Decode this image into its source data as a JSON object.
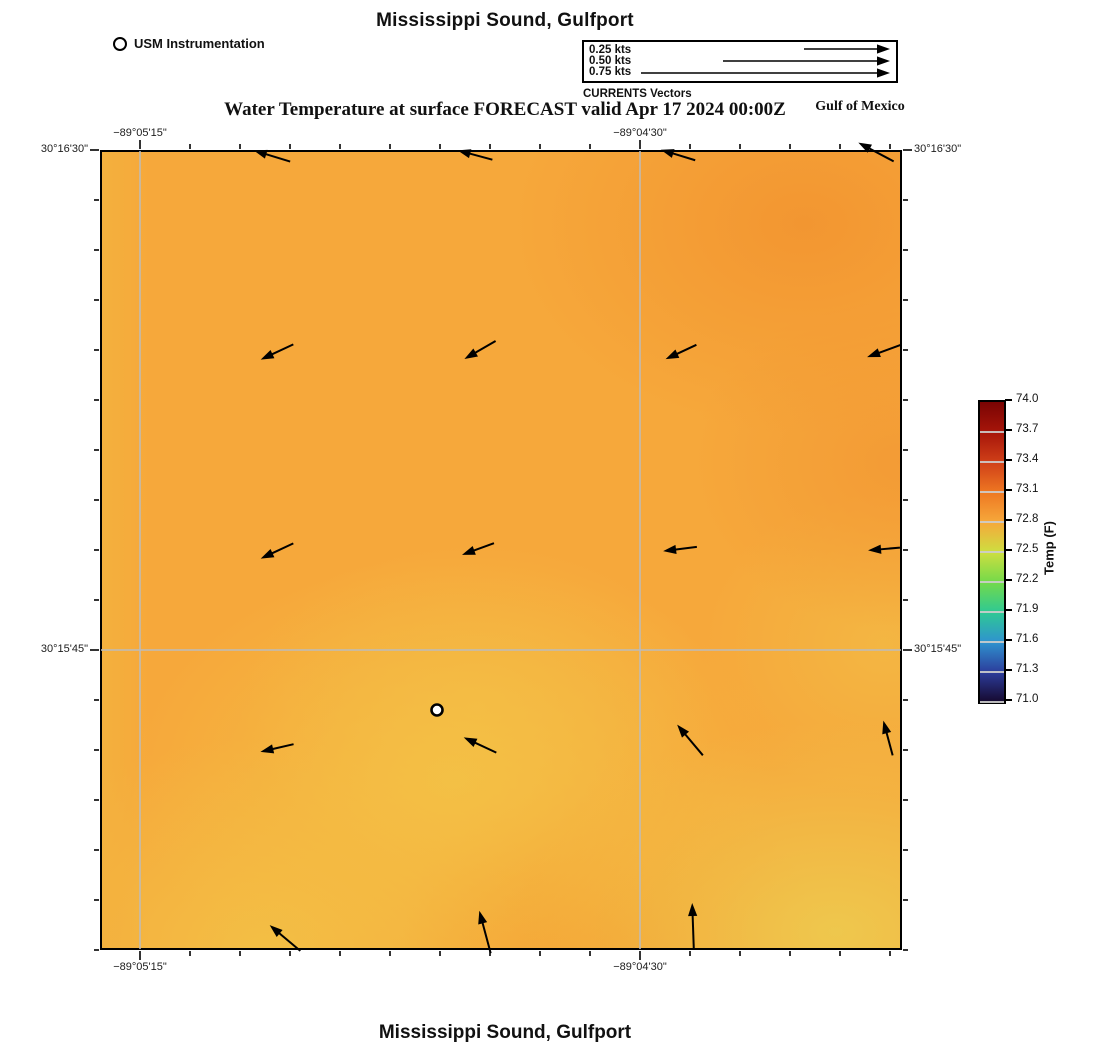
{
  "titles": {
    "top": "Mississippi Sound, Gulfport",
    "forecast": "Water Temperature at surface FORECAST valid Apr 17 2024 00:00Z",
    "region": "Gulf of Mexico",
    "bottom": "Mississippi Sound, Gulfport"
  },
  "vector_legend": {
    "caption": "CURRENTS Vectors",
    "entries": [
      {
        "label": "0.25 kts",
        "len_px": 86
      },
      {
        "label": "0.50 kts",
        "len_px": 167
      },
      {
        "label": "0.75 kts",
        "len_px": 249
      }
    ]
  },
  "chart_data": {
    "type": "heatmap",
    "title": "Mississippi Sound, Gulfport",
    "subtitle": "Water Temperature at surface FORECAST valid Apr 17 2024 00:00Z",
    "footer_title": "Mississippi Sound, Gulfport",
    "area_label": "Gulf of Mexico",
    "variable": "Water Temperature at surface",
    "units": "F",
    "legend_station_label": "USM Instrumentation",
    "colorbar": {
      "label": "Temp (F)",
      "min": 71.0,
      "max": 74.0,
      "tick_step": 0.3,
      "tick_labels": [
        "74.0",
        "73.7",
        "73.4",
        "73.1",
        "72.8",
        "72.5",
        "72.2",
        "71.9",
        "71.6",
        "71.3",
        "71.0"
      ],
      "colors_top_to_bottom": [
        "#7a0403",
        "#a6150a",
        "#cf3f18",
        "#ee7722",
        "#f6a83b",
        "#cede40",
        "#74da4a",
        "#2fc993",
        "#2f93cf",
        "#2c3d9c",
        "#16092f"
      ]
    },
    "x_axis": {
      "tick_labels": [
        "−89°05'15\"",
        "−89°04'30\""
      ],
      "tick_px": [
        140,
        640
      ],
      "minor_tick_step_px": 50
    },
    "y_axis": {
      "tick_labels": [
        "30°16'30\"",
        "30°15'45\""
      ],
      "tick_px": [
        150,
        650
      ],
      "minor_tick_step_px": 50
    },
    "grid": {
      "vertical_x_px": [
        140,
        640
      ],
      "horizontal_y_px": [
        650
      ]
    },
    "frame_px": {
      "left": 100,
      "top": 150,
      "right": 902,
      "bottom": 950
    },
    "station_marker": {
      "label": "USM Instrumentation",
      "x_px": 437,
      "y_px": 710
    },
    "current_speed_legend_kts": [
      0.25,
      0.5,
      0.75
    ],
    "vectors_px": [
      {
        "x": 272,
        "y": 156,
        "deg": 163,
        "len": 38
      },
      {
        "x": 475,
        "y": 155,
        "deg": 165,
        "len": 36
      },
      {
        "x": 678,
        "y": 155,
        "deg": 163,
        "len": 36
      },
      {
        "x": 876,
        "y": 152,
        "deg": 152,
        "len": 40
      },
      {
        "x": 277,
        "y": 352,
        "deg": 205,
        "len": 36
      },
      {
        "x": 480,
        "y": 350,
        "deg": 210,
        "len": 36
      },
      {
        "x": 681,
        "y": 352,
        "deg": 205,
        "len": 34
      },
      {
        "x": 884,
        "y": 351,
        "deg": 200,
        "len": 36
      },
      {
        "x": 277,
        "y": 551,
        "deg": 205,
        "len": 36
      },
      {
        "x": 478,
        "y": 549,
        "deg": 200,
        "len": 34
      },
      {
        "x": 680,
        "y": 549,
        "deg": 187,
        "len": 34
      },
      {
        "x": 884,
        "y": 549,
        "deg": 185,
        "len": 32
      },
      {
        "x": 277,
        "y": 748,
        "deg": 193,
        "len": 34
      },
      {
        "x": 480,
        "y": 745,
        "deg": 155,
        "len": 36
      },
      {
        "x": 690,
        "y": 740,
        "deg": 130,
        "len": 40
      },
      {
        "x": 888,
        "y": 738,
        "deg": 105,
        "len": 36
      },
      {
        "x": 285,
        "y": 938,
        "deg": 140,
        "len": 40
      },
      {
        "x": 485,
        "y": 932,
        "deg": 105,
        "len": 44
      },
      {
        "x": 693,
        "y": 926,
        "deg": 92,
        "len": 46
      }
    ]
  }
}
